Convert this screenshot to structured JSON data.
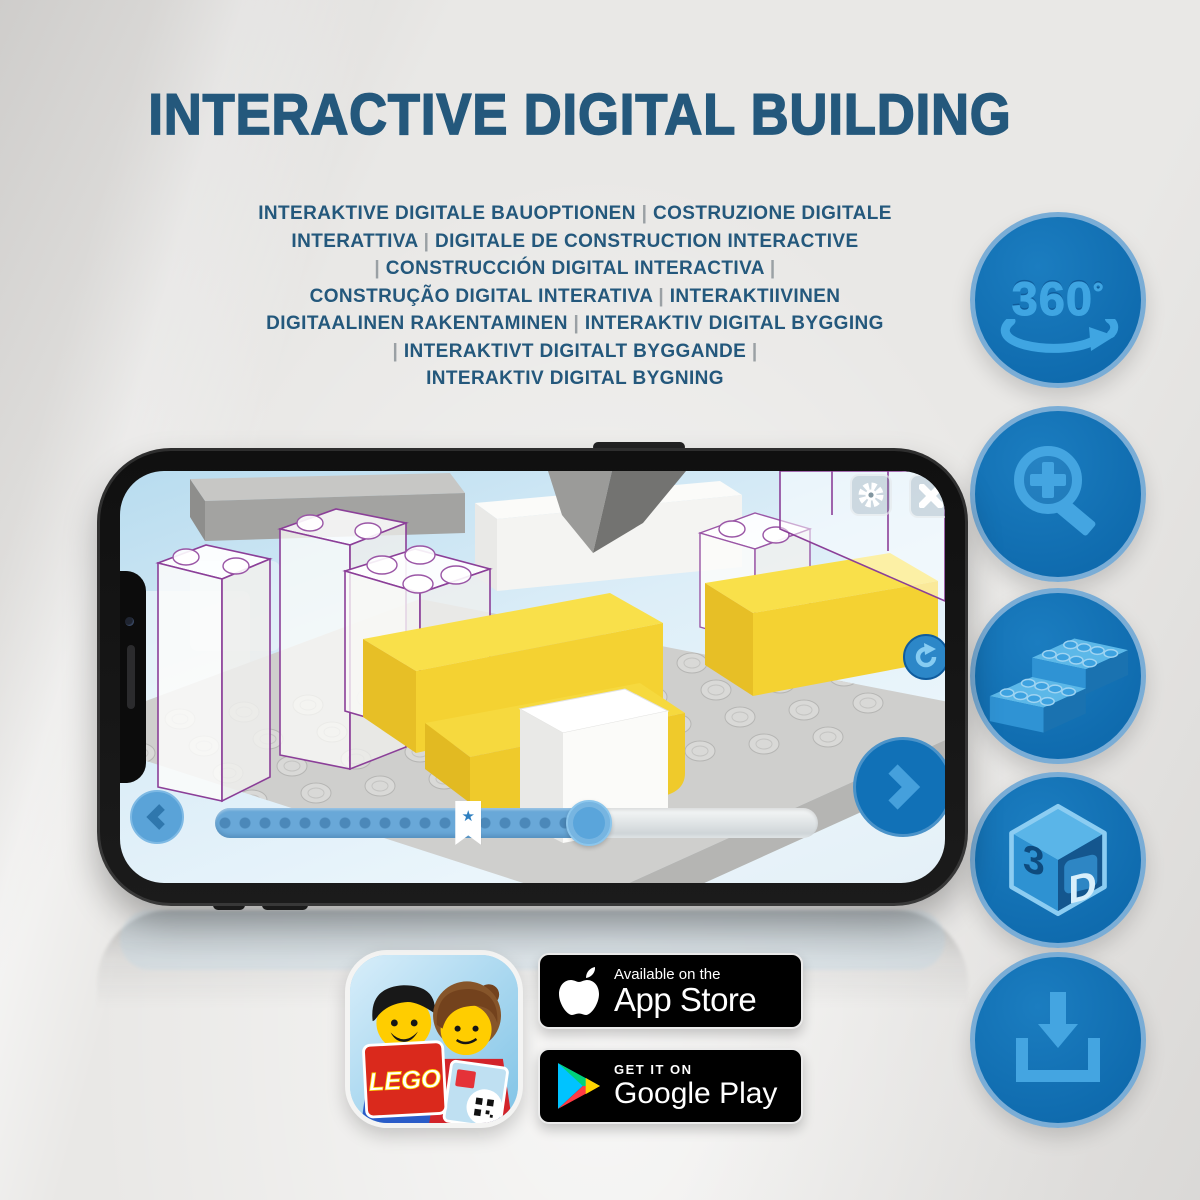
{
  "poster": {
    "title": "INTERACTIVE DIGITAL BUILDING",
    "subtitle_lines": [
      "INTERAKTIVE DIGITALE BAUOPTIONEN | COSTRUZIONE DIGITALE",
      "INTERATTIVA | DIGITALE DE CONSTRUCTION INTERACTIVE",
      "| CONSTRUCCIÓN DIGITAL INTERACTIVA |",
      "CONSTRUÇÃO DIGITAL INTERATIVA | INTERAKTIIVINEN",
      "DIGITAALINEN RAKENTAMINEN | INTERAKTIV DIGITAL BYGGING",
      "| INTERAKTIVT DIGITALT BYGGANDE |",
      "INTERAKTIV DIGITAL BYGNING"
    ]
  },
  "features": {
    "rotate_360": {
      "value": "360",
      "degree": "°"
    },
    "cube_3d": {
      "left": "3",
      "right": "D"
    }
  },
  "phone": {
    "app_screen": {
      "progress": {
        "filled_percent": 62,
        "star_percent": 42,
        "dot_count": 19
      }
    }
  },
  "badges": {
    "app_store": {
      "line1": "Available on the",
      "line2": "App Store"
    },
    "google_play": {
      "line1": "GET IT ON",
      "line2": "Google Play"
    }
  },
  "app_icon": {
    "logo_text": "LEGO"
  },
  "colors": {
    "title_blue": "#24587c",
    "lego_circle_blue": "#1070b4",
    "icon_light_blue": "#44a5e1",
    "brick_yellow": "#f4d232",
    "ghost_outline_purple": "#8b3f98",
    "badge_black": "#000000"
  }
}
